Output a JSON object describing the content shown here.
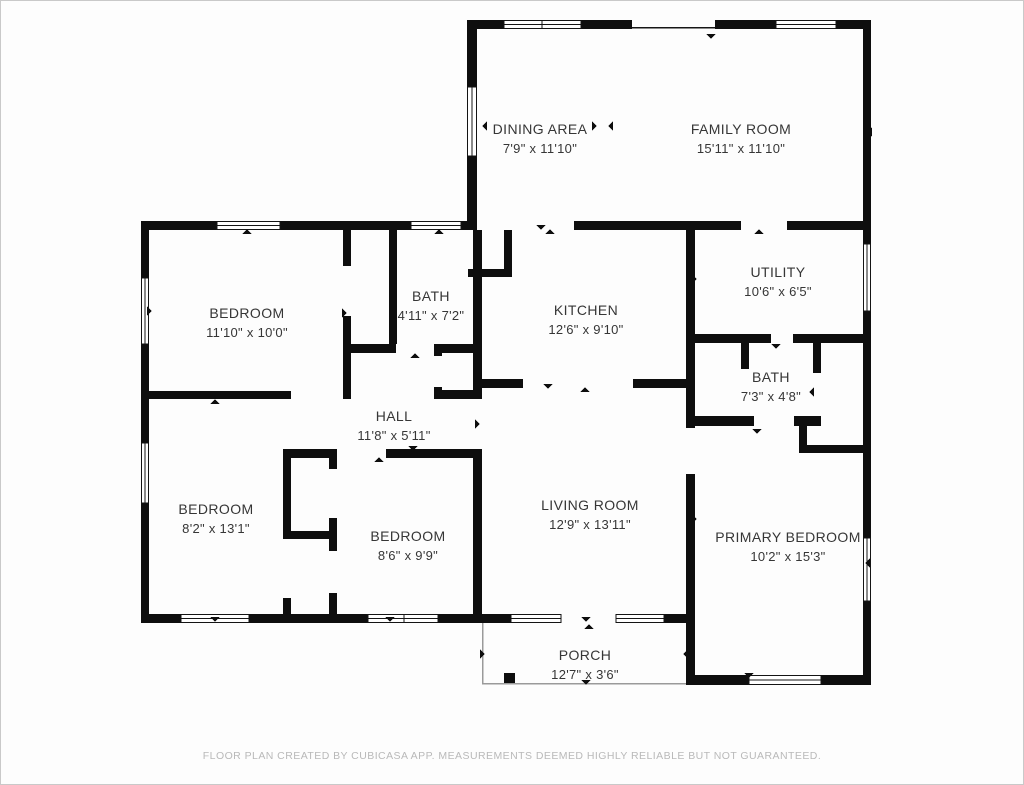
{
  "footer": {
    "text": "FLOOR PLAN CREATED BY CUBICASA APP. MEASUREMENTS DEEMED HIGHLY RELIABLE BUT NOT GUARANTEED."
  },
  "rooms": [
    {
      "name": "DINING AREA",
      "dims": "7'9\" x 11'10\""
    },
    {
      "name": "FAMILY ROOM",
      "dims": "15'11\" x 11'10\""
    },
    {
      "name": "BEDROOM",
      "dims": "11'10\" x 10'0\""
    },
    {
      "name": "BATH",
      "dims": "4'11\" x 7'2\""
    },
    {
      "name": "KITCHEN",
      "dims": "12'6\" x 9'10\""
    },
    {
      "name": "UTILITY",
      "dims": "10'6\" x 6'5\""
    },
    {
      "name": "BATH",
      "dims": "7'3\" x 4'8\""
    },
    {
      "name": "HALL",
      "dims": "11'8\" x 5'11\""
    },
    {
      "name": "BEDROOM",
      "dims": "8'2\" x 13'1\""
    },
    {
      "name": "BEDROOM",
      "dims": "8'6\" x 9'9\""
    },
    {
      "name": "LIVING ROOM",
      "dims": "12'9\" x 13'11\""
    },
    {
      "name": "PRIMARY BEDROOM",
      "dims": "10'2\" x 15'3\""
    },
    {
      "name": "PORCH",
      "dims": "12'7\" x 3'6\""
    }
  ],
  "colors": {
    "wall": "#0e0e0e",
    "label": "#363636",
    "footer_text": "#b9b9b9"
  }
}
